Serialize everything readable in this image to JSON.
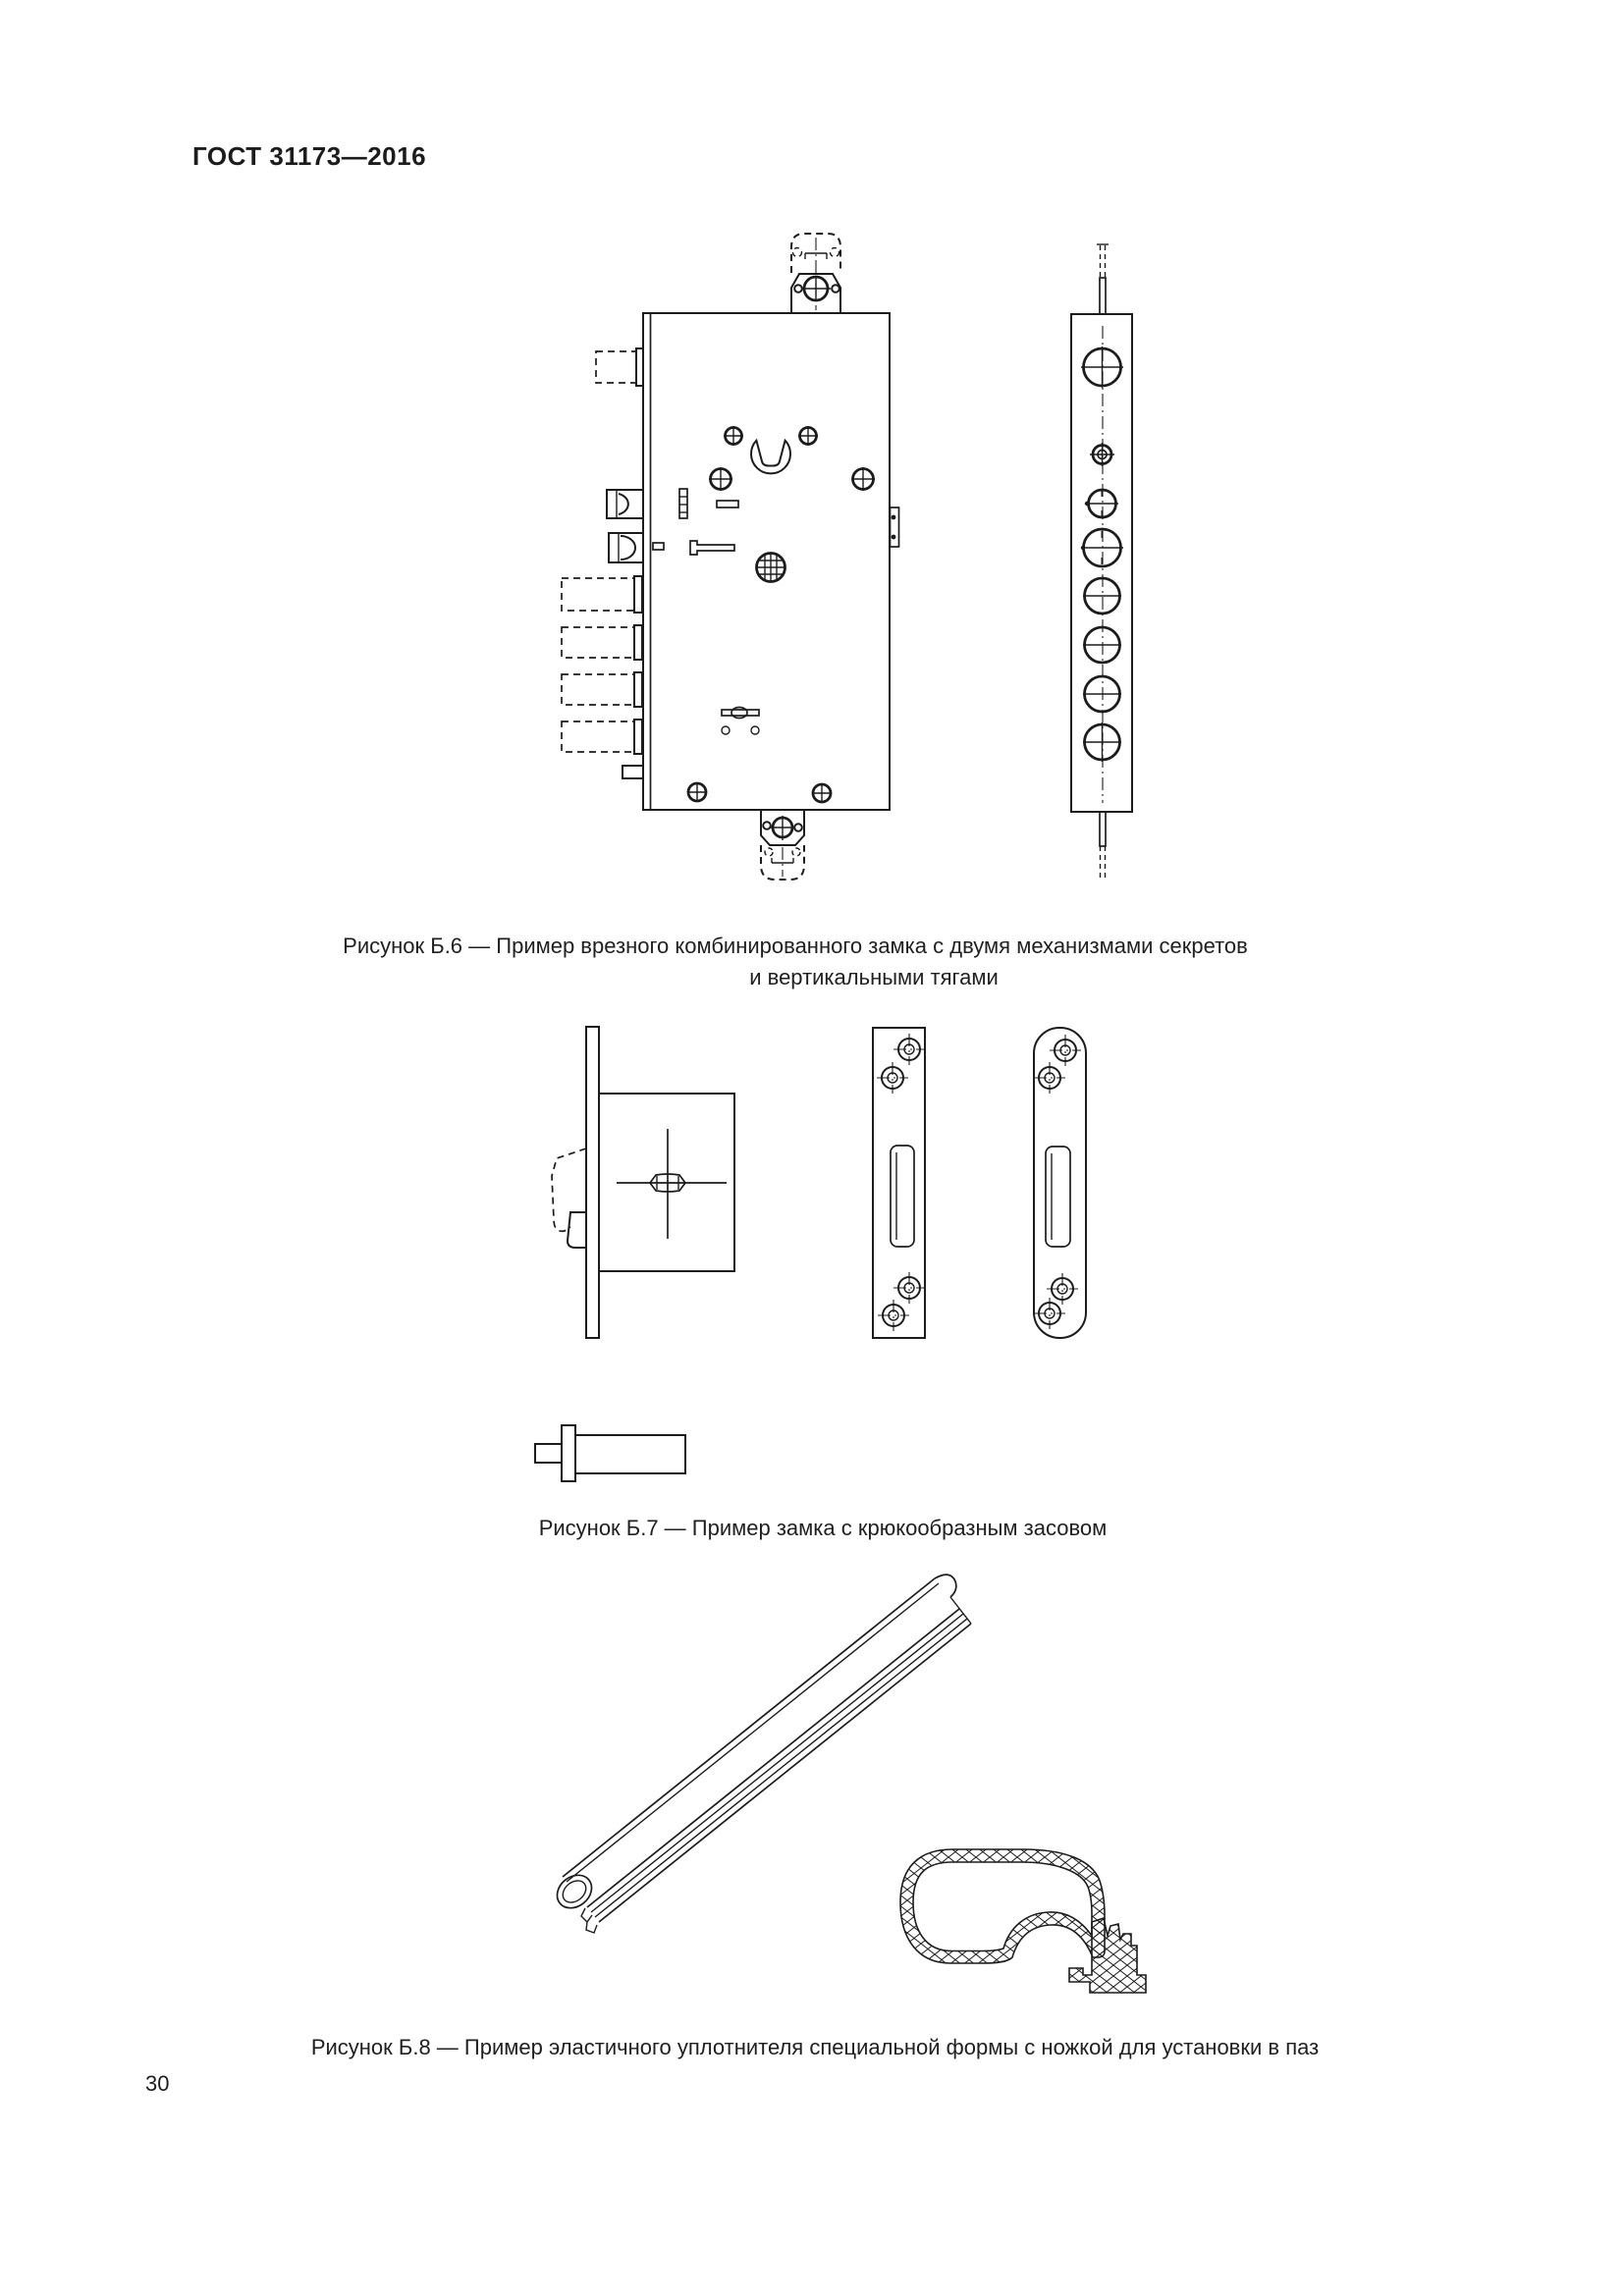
{
  "document": {
    "standard_code": "ГОСТ 31173—2016",
    "page_number": "30"
  },
  "figures": {
    "b6": {
      "caption_line1": "Рисунок Б.6 — Пример врезного комбинированного замка с двумя механизмами секретов",
      "caption_line2": "и вертикальными тягами"
    },
    "b7": {
      "caption": "Рисунок Б.7 — Пример замка с крюкообразным засовом"
    },
    "b8": {
      "caption": "Рисунок Б.8 — Пример эластичного уплотнителя специальной формы с ножкой для установки в паз"
    }
  },
  "colors": {
    "ink": "#1c1c1c",
    "paper": "#ffffff"
  }
}
